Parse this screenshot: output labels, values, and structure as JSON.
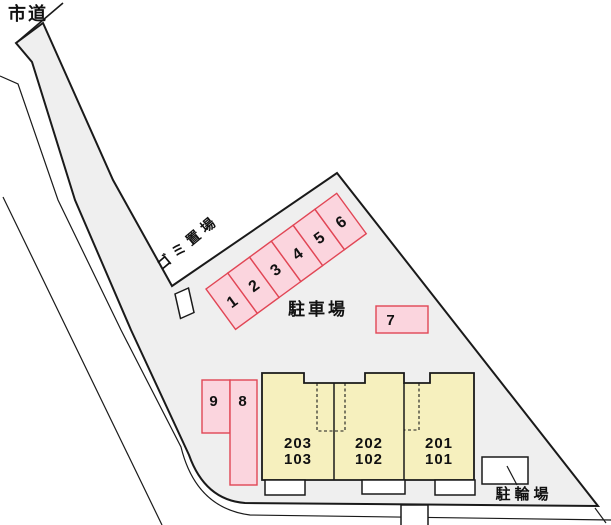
{
  "labels": {
    "city_road": "市道",
    "garbage_area": "ゴミ置場",
    "parking_lot": "駐車場",
    "bicycle_parking": "駐輪場"
  },
  "parking": {
    "spaces": [
      "1",
      "2",
      "3",
      "4",
      "5",
      "6"
    ],
    "space_7": "7",
    "space_8": "8",
    "space_9": "9"
  },
  "building": {
    "units": [
      {
        "upper": "203",
        "lower": "103"
      },
      {
        "upper": "202",
        "lower": "102"
      },
      {
        "upper": "201",
        "lower": "101"
      }
    ]
  },
  "colors": {
    "lot_fill": "#efefef",
    "line": "#1a1a1a",
    "text_color": "#111111",
    "parking_fill": "#fbd5de",
    "parking_border": "#e14655",
    "building_fill": "#f6f0be",
    "box_fill": "#ffffff"
  }
}
